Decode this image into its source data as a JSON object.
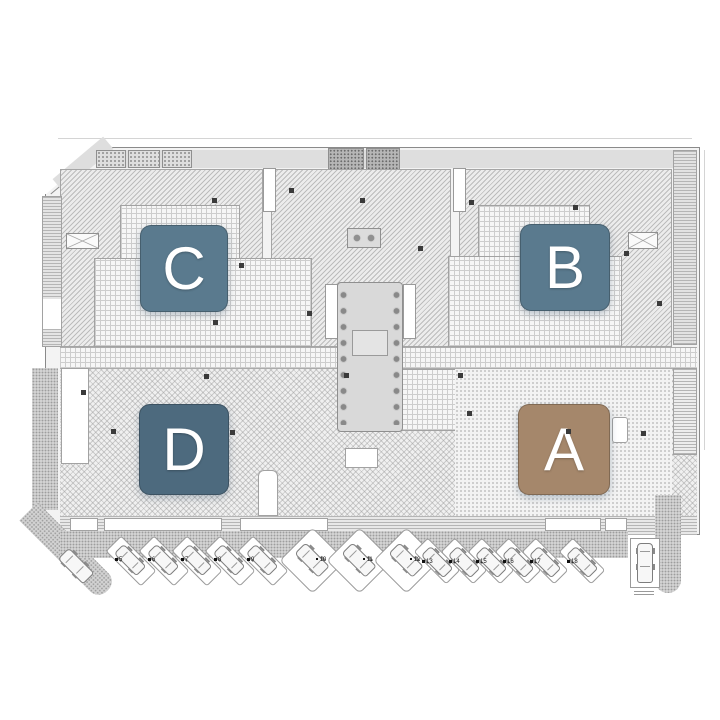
{
  "plan": {
    "letter_color": "#ffffff",
    "blocks": {
      "A": {
        "label": "A",
        "color": "#a5876b"
      },
      "B": {
        "label": "B",
        "color": "#5a7a8e"
      },
      "C": {
        "label": "C",
        "color": "#5a7a8e"
      },
      "D": {
        "label": "D",
        "color": "#4d6a7e"
      }
    }
  },
  "parking": {
    "angled_left": [
      "5",
      "6",
      "7",
      "8",
      "9"
    ],
    "bay_center": [
      "10",
      "11",
      "12"
    ],
    "angled_right": [
      "13",
      "14",
      "15",
      "16",
      "17",
      "18"
    ]
  }
}
